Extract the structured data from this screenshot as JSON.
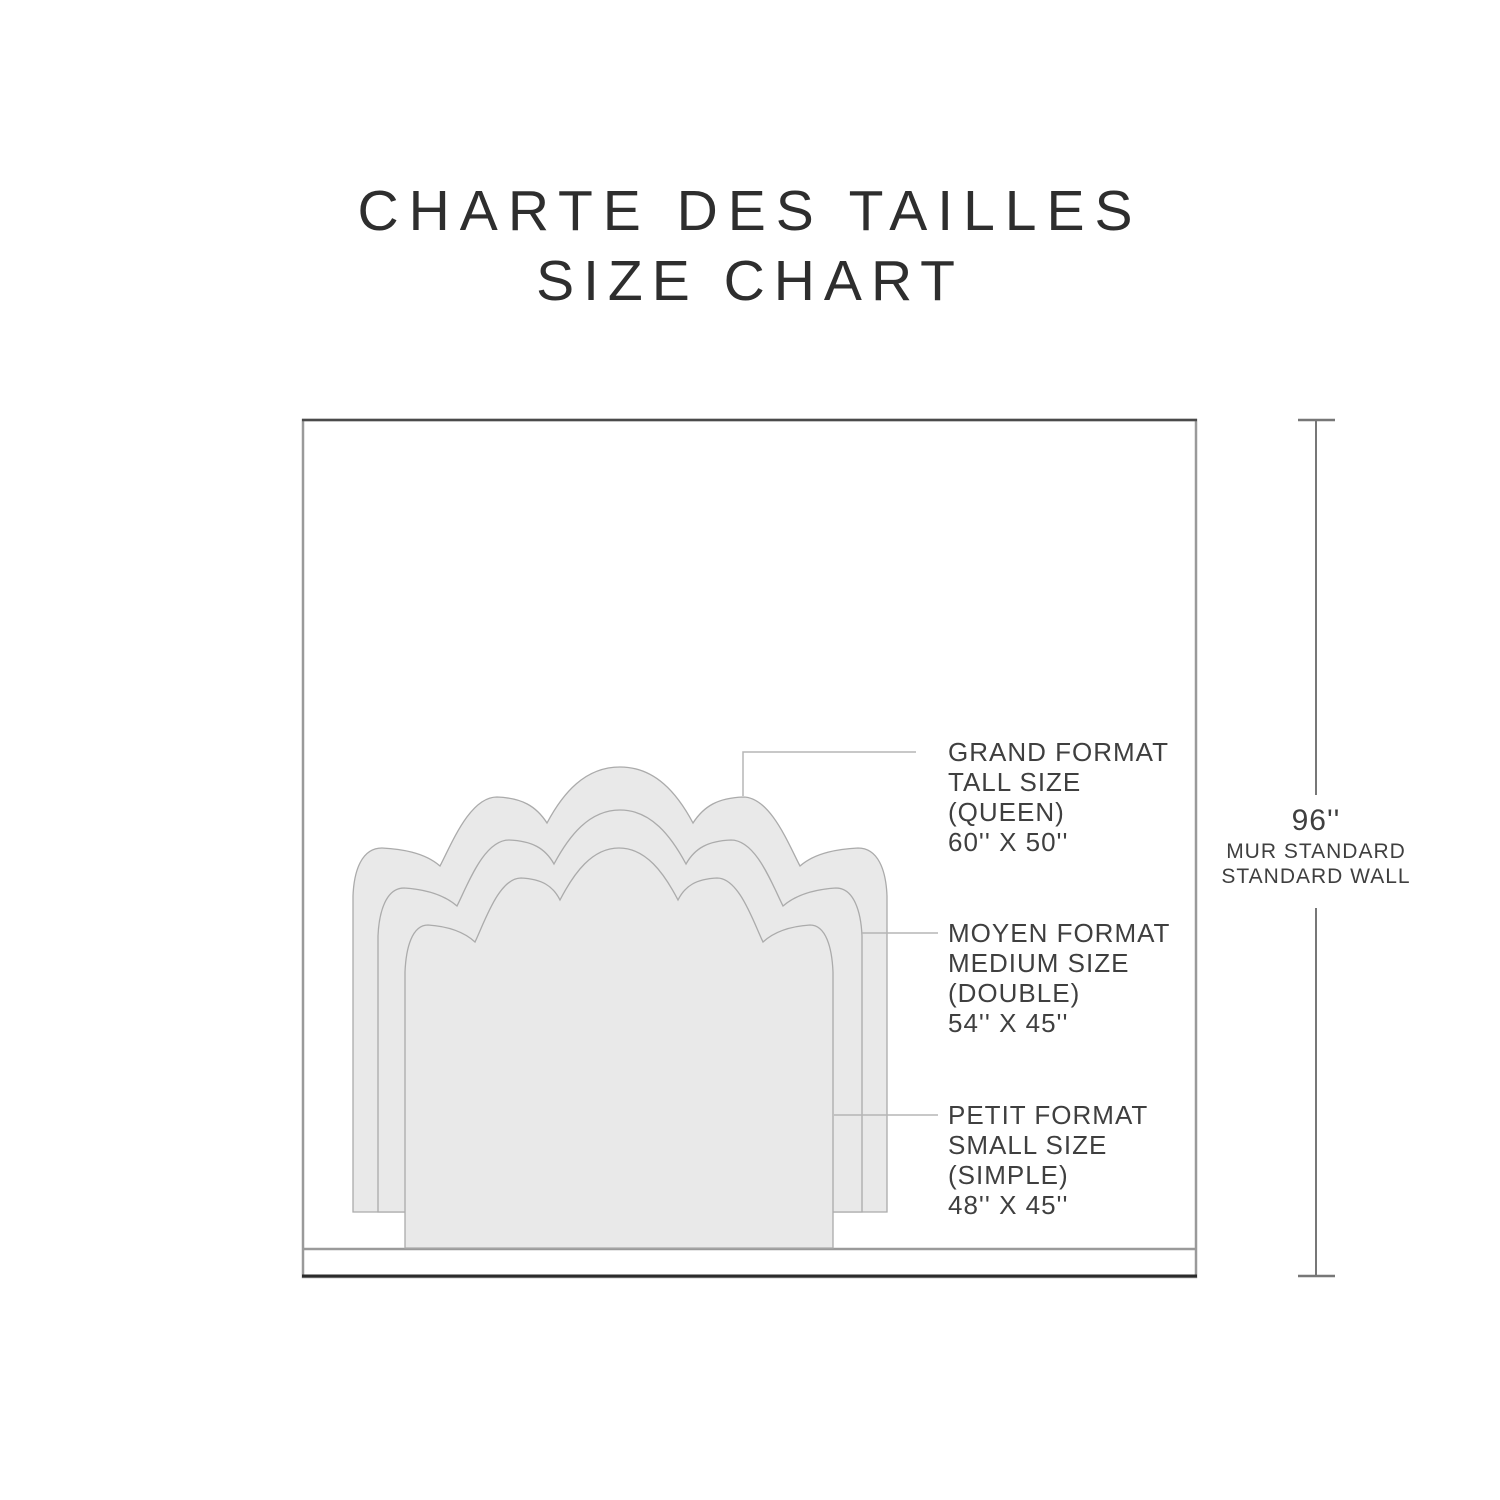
{
  "title": {
    "line1": "CHARTE DES TAILLES",
    "line2": "SIZE CHART"
  },
  "sizes": [
    {
      "id": "tall",
      "lines": [
        "GRAND FORMAT",
        "TALL SIZE",
        "(QUEEN)",
        "60'' X 50''"
      ]
    },
    {
      "id": "medium",
      "lines": [
        "MOYEN FORMAT",
        "MEDIUM SIZE",
        "(DOUBLE)",
        "54'' X 45''"
      ]
    },
    {
      "id": "small",
      "lines": [
        "PETIT FORMAT",
        "SMALL SIZE",
        "(SIMPLE)",
        "48'' X 45''"
      ]
    }
  ],
  "wall_measure": {
    "value": "96''",
    "line1": "MUR STANDARD",
    "line2": "STANDARD WALL"
  },
  "colors": {
    "headboard_fill": "#e9e9e9",
    "headboard_stroke": "#ababab",
    "wall_stroke": "#9a9a9a",
    "wall_top_stroke": "#4a4a4a",
    "wall_bottom_stroke": "#2b2b2b",
    "floor_stroke": "#9a9a9a",
    "leader_stroke": "#b5b5b5",
    "measure_stroke": "#777777",
    "text_color": "#3f3f3f"
  }
}
